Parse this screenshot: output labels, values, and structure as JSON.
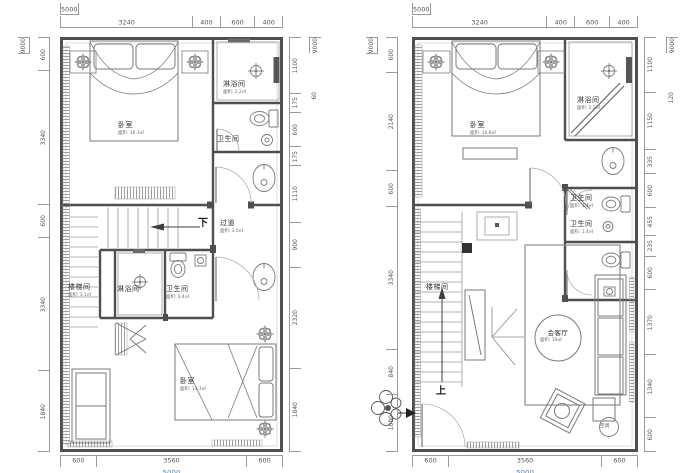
{
  "document": {
    "type": "residential duplex floor plans",
    "background": "#ffffff",
    "wall_color": "#4f4f4f",
    "dim_line_color": "#9a9a9a",
    "dim_text_color": "#555555",
    "accent_blue": "#4f86c6"
  },
  "plan_left": {
    "dims": {
      "top_total": "5000",
      "top_segments": [
        "3240",
        "400",
        "600",
        "400"
      ],
      "left_total": "9000",
      "left_segments": [
        "600",
        "3340",
        "600",
        "3340",
        "1840"
      ],
      "right_segments": [
        "1100",
        "175",
        "600",
        "175",
        "1110",
        "900",
        "2320",
        "1840"
      ],
      "right_total": "9000",
      "right_extra": "60",
      "bottom_segments": [
        "600",
        "3560",
        "600"
      ],
      "bottom_total": "5000"
    },
    "labels": {
      "bedroom_top": {
        "name": "卧室",
        "area": "面积: 16.3㎡"
      },
      "shower_top": {
        "name": "淋浴间",
        "area": "面积: 2.2㎡"
      },
      "wc_top": {
        "name": "卫生间"
      },
      "corridor": {
        "name": "过道",
        "area": "面积: 3.0㎡"
      },
      "down": "下",
      "stairwell": {
        "name": "楼梯间",
        "area": "面积: 3.1㎡"
      },
      "shower_mid": {
        "name": "淋浴间"
      },
      "wc_mid": {
        "name": "卫生间",
        "area": "面积: 3.4㎡"
      },
      "bedroom_bottom": {
        "name": "卧室",
        "area": "面积: 14.3㎡"
      }
    }
  },
  "plan_right": {
    "dims": {
      "top_total": "5000",
      "top_segments": [
        "3240",
        "400",
        "600",
        "400"
      ],
      "left_total": "9000",
      "left_segments": [
        "600",
        "2140",
        "600",
        "3340",
        "840",
        "1080"
      ],
      "right_segments": [
        "1100",
        "1150",
        "335",
        "600",
        "455",
        "235",
        "600",
        "1370",
        "1340",
        "600"
      ],
      "right_total": "9000",
      "right_extra": "120",
      "bottom_segments": [
        "600",
        "3560",
        "600"
      ],
      "bottom_total": "5000"
    },
    "labels": {
      "bedroom": {
        "name": "卧室",
        "area": "面积: 10.8㎡"
      },
      "shower": {
        "name": "淋浴间",
        "area": "面积: 2.2㎡"
      },
      "wc_upper": {
        "name": "卫生间",
        "area": "面积: 1.4㎡"
      },
      "wc_lower": {
        "name": "卫生间",
        "area": "面积: 1.4㎡"
      },
      "stairwell": {
        "name": "楼梯间"
      },
      "living": {
        "name": "会客厅",
        "area": "面积: 19㎡"
      },
      "up": "上",
      "ac": "空调"
    }
  }
}
